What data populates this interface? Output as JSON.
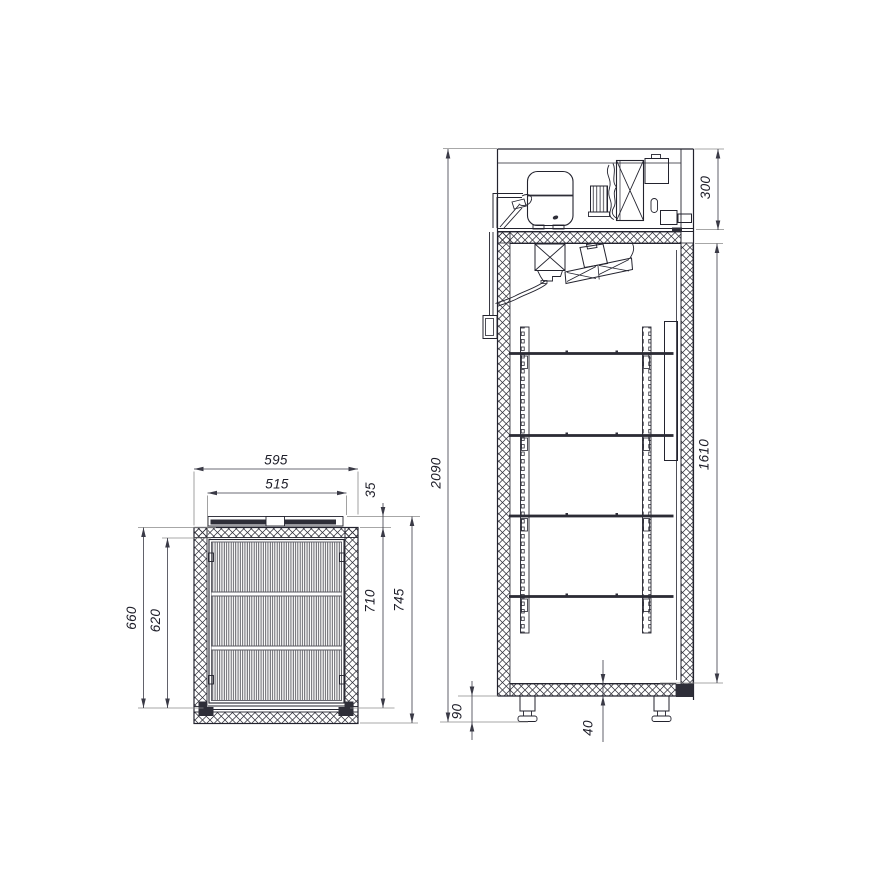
{
  "page": {
    "background": "#ffffff"
  },
  "drawing": {
    "kind": "refrigerated-cabinet-technical-drawing",
    "line_color": "#23232e",
    "dim_color": "#3a3a46",
    "top_view": {
      "name": "plan-section-view",
      "dims": {
        "outer_width": "595",
        "inner_width": "515",
        "door_thickness": "35",
        "depth_opening_a": "660",
        "depth_opening_b": "620",
        "body_depth": "710",
        "overall_depth": "745"
      }
    },
    "side_view": {
      "name": "side-section-view",
      "dims": {
        "overall_height": "2090",
        "machine_compartment": "300",
        "interior_height": "1610",
        "leg_height": "90",
        "bottom_insulation": "40"
      }
    }
  }
}
